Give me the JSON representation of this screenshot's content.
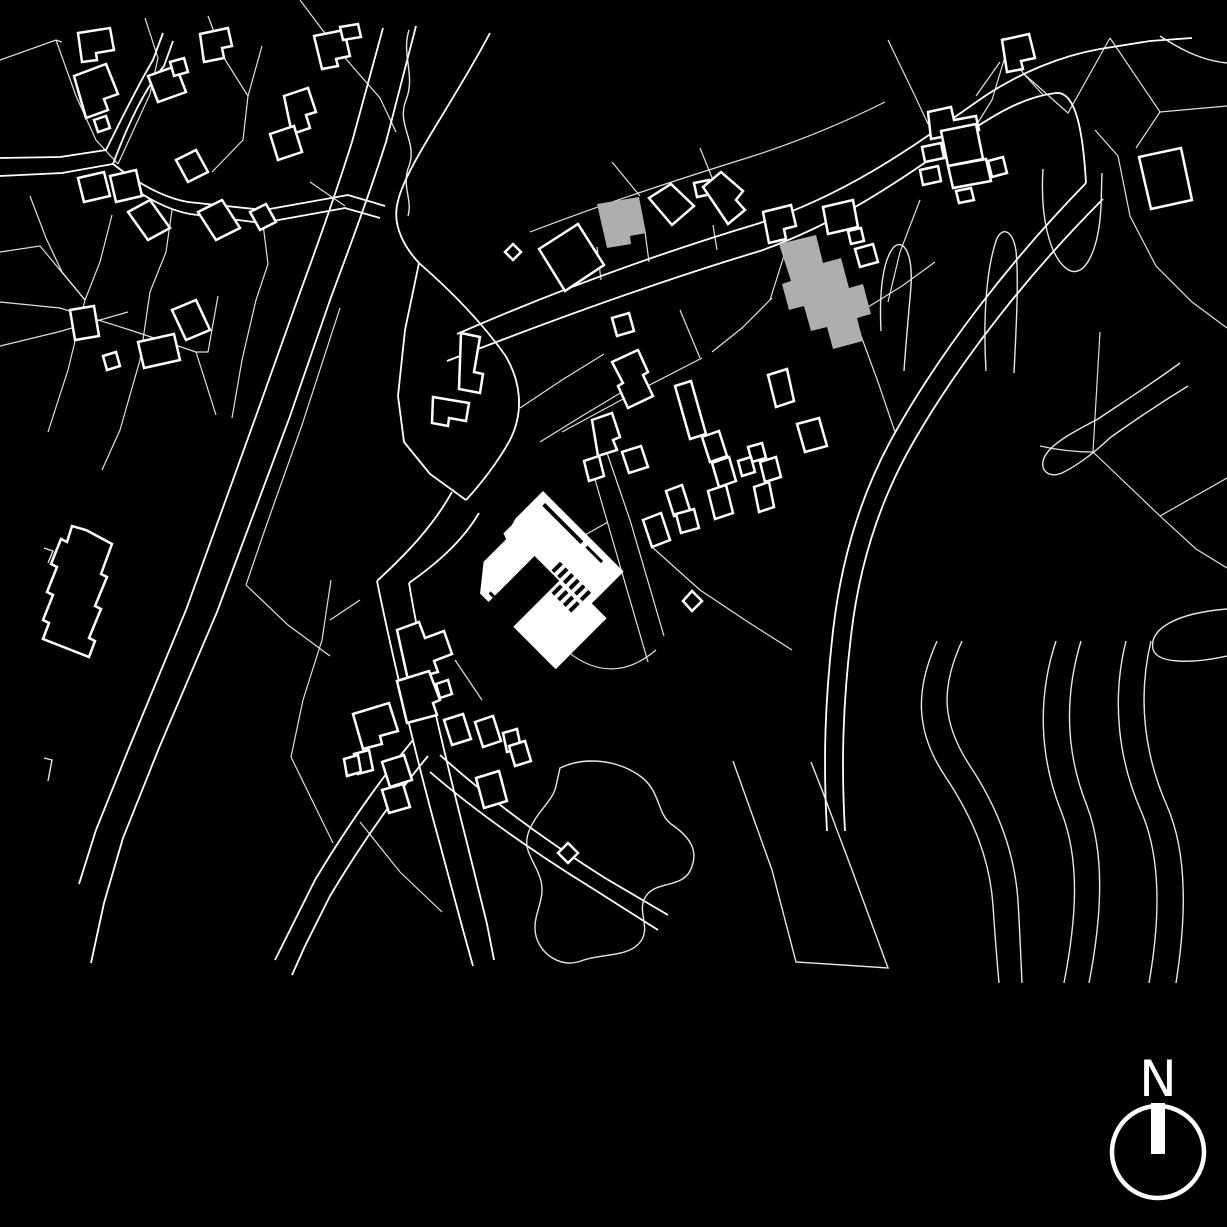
{
  "meta": {
    "type": "architectural site plan",
    "style": "black figure-ground drawing"
  },
  "colors": {
    "background": "#000000",
    "linework": "#f2f2f2",
    "highlight": "#ffffff",
    "context_fill": "#aeaeae"
  },
  "north_arrow": {
    "label": "N"
  },
  "map": {
    "parcel_lines": [
      "M 0,60 L 56,40 L 62,42",
      "M 56,40 L 76,96 L 96,140 L 118,164",
      "M 145,18 L 158,58 L 150,94",
      "M 208,16 L 224,58 L 248,96 L 243,140 L 212,172",
      "M 248,96 L 262,46",
      "M 300,0 L 330,40 L 352,66",
      "M 352,66 L 380,98 L 396,132",
      "M 150,94 L 118,164",
      "M 30,196 L 46,238 L 62,272 L 85,300",
      "M 112,215 L 100,262 L 85,300",
      "M 172,210 L 166,252 L 150,292",
      "M 263,224 L 268,264 L 256,300",
      "M 310,182 L 345,206",
      "M 0,252 L 40,246 L 85,300",
      "M 85,300 L 68,370 L 48,432",
      "M 150,292 L 140,360 L 120,430 L 102,470",
      "M 256,300 L 242,360 L 232,418",
      "M 0,346 L 58,332 L 128,312",
      "M 0,302 L 60,308 L 130,330 L 196,352",
      "M 218,296 L 208,352 L 196,352",
      "M 196,352 L 216,415",
      "M 340,308 L 302,425 L 263,535 L 246,585",
      "M 246,585 L 288,625 L 330,656",
      "M 530,232 C 600,205 670,182 750,157 C 800,141 845,122 885,102",
      "M 612,162 L 640,196",
      "M 700,148 L 713,180",
      "M 597,247 L 601,280",
      "M 645,232 L 649,262",
      "M 713,225 L 717,250",
      "M 770,300 L 788,243",
      "M 772,298 L 742,328 L 712,352",
      "M 860,333 L 878,382 L 895,432",
      "M 868,307 L 902,286 L 935,262",
      "M 680,310 L 700,358",
      "M 562,432 L 636,392 L 702,358",
      "M 652,547 L 700,590 L 748,622 L 792,650",
      "M 540,560 L 576,540 L 608,522",
      "M 590,462 L 614,545 L 648,662",
      "M 606,450 L 630,520 L 664,636",
      "M 520,408 L 562,380 L 604,354",
      "M 540,442 L 582,416 L 622,392",
      "M 331,580 L 322,640 L 303,700 L 291,757",
      "M 291,757 L 312,800 L 333,843",
      "M 360,822 L 400,872 L 442,912",
      "M 455,660 L 482,700",
      "M 330,620 L 360,600",
      "M 560,645 C 595,678 628,674 656,650",
      "M 888,40 L 915,96 L 928,124",
      "M 1010,40 L 992,100 L 977,124",
      "M 920,200 L 900,252 L 888,302",
      "M 1000,62 L 976,96",
      "M 1003,38 L 1023,73 L 1044,96",
      "M 1023,73 L 1068,113 L 1110,38",
      "M 1110,38 L 1160,112 L 1227,106",
      "M 1160,112 L 1136,148",
      "M 1118,156 L 1130,216 L 1156,266 L 1192,302 L 1227,328",
      "M 1095,130 L 1118,156",
      "M 1100,332 L 1093,452",
      "M 1040,446 C 1062,451 1080,452 1093,452",
      "M 1093,452 L 1160,516 L 1196,549 L 1227,568",
      "M 1160,516 L 1227,478"
    ],
    "roads": [
      "M 383,28 L 352,142 C 330,212 311,262 297,301 L 256,416 L 186,610 L 129,748 L 96,830 L 79,884",
      "M 416,26 L 386,142 C 363,214 343,264 329,303 L 289,419 L 217,612 L 159,748 L 123,838 L 104,903 L 91,963",
      "M 0,158 L 60,157 L 106,150 C 122,118 138,85 153,60 L 163,33",
      "M 0,176 L 62,173 L 113,164 C 128,124 144,90 164,66 L 173,41",
      "M 113,164 C 140,185 165,198 188,202 L 264,210 L 348,195 L 385,206",
      "M 117,177 C 145,198 168,210 190,214 L 262,223 L 345,208 L 380,218",
      "M 457,334 C 560,289 660,253 760,223 C 855,191 920,141 985,96 C 1020,73 1060,56 1100,49 L 1150,41 L 1192,38",
      "M 447,361 C 560,317 660,281 760,251 C 850,219 912,171 975,128 C 1005,108 1030,96 1056,93 C 1076,91 1083,132 1086,183",
      "M 490,33 C 452,105 406,166 398,201 C 391,226 406,249 419,263 C 450,290 480,320 505,355 C 520,380 525,410 510,440 C 498,462 480,485 466,500",
      "M 419,263 L 405,330 L 398,396 L 404,442 L 430,474 L 466,500",
      "M 452,492 C 432,528 404,556 377,581",
      "M 479,513 C 462,542 436,564 409,583",
      "M 377,581 C 391,650 416,758 441,848 L 463,930 L 473,966",
      "M 409,583 C 420,650 444,753 467,843 L 487,924 L 494,960",
      "M 413,740 C 380,780 345,830 315,880 L 290,930 L 275,960",
      "M 428,756 C 395,796 360,846 330,896 L 305,946 L 292,975",
      "M 440,755 C 490,800 545,840 605,878 L 668,915",
      "M 430,772 C 480,815 535,853 595,890 L 658,930",
      "M 1086,183 C 1010,261 941,351 896,431 C 861,492 841,561 833,631 C 825,701 823,761 827,831",
      "M 1103,199 C 1026,276 959,363 914,441 C 879,501 859,566 851,636 C 843,703 841,763 845,831"
    ],
    "organic_lines": [
      "M 409,30 C 401,55 416,75 406,100 C 396,125 418,142 409,166 C 401,186 413,200 408,216",
      "M 560,768 C 585,756 618,760 640,776 C 661,791 656,812 671,824 C 690,837 700,851 690,871 C 681,888 656,881 646,896 C 636,911 651,926 641,941 C 629,958 601,953 581,961 C 561,968 541,955 536,936 C 531,916 546,901 541,881 C 536,861 521,851 529,831 C 537,811 553,801 556,786 Z",
      "M 733,761 L 772,870 L 796,962 L 888,968 L 852,870 L 822,790 L 811,762",
      "M 937,641 C 915,690 915,731 945,776 C 975,821 990,861 993,906 C 995,936 997,961 999,983",
      "M 962,641 C 940,689 942,723 970,766 C 1000,811 1015,856 1018,901 C 1020,936 1021,961 1022,983",
      "M 1056,641 C 1036,701 1041,761 1061,811 C 1081,861 1076,921 1064,983",
      "M 1081,641 C 1063,701 1067,756 1087,806 C 1106,856 1101,921 1089,983",
      "M 1126,641 C 1111,701 1119,761 1141,811 C 1163,861 1159,926 1149,983",
      "M 1151,641 C 1137,699 1145,756 1167,806 C 1189,856 1185,926 1176,983",
      "M 1227,609 C 1176,613 1149,629 1153,649 C 1157,665 1196,663 1227,656",
      "M 1098,419 C 1075,431 1052,443 1045,456 C 1038,469 1048,479 1062,473 C 1082,463 1098,449 1111,437",
      "M 1098,419 C 1120,404 1150,385 1180,363",
      "M 1111,437 C 1135,420 1162,402 1188,386",
      "M 1043,169 C 1040,215 1049,256 1067,269 C 1085,281 1099,249 1101,206 L 1102,173",
      "M 881,331 C 879,291 883,261 893,248 C 903,237 913,253 911,286 C 909,311 906,341 904,371",
      "M 986,371 C 983,321 986,271 996,241 C 1001,226 1013,229 1016,251 C 1019,281 1016,331 1014,373",
      "M 1160,36 C 1186,53 1206,61 1227,63",
      "M 44,548 L 53,551 L 48,563",
      "M 44,758 L 52,760 L 48,781"
    ],
    "building_outlines": [
      "M 78,33 L 110,28 L 114,50 L 96,53 L 97,60 L 82,62 Z",
      "M 74,76 L 106,64 L 118,94 L 104,99 L 108,110 L 86,118 Z",
      "M 148,76 L 176,66 L 186,92 L 158,102 Z",
      "M 170,62 L 184,58 L 188,72 L 174,76 Z",
      "M 200,34 L 228,28 L 232,46 L 222,48 L 224,58 L 204,62 Z",
      "M 94,120 L 106,116 L 110,128 L 98,132 Z",
      "M 176,160 L 196,150 L 208,172 L 188,182 Z",
      "M 78,178 L 104,172 L 110,196 L 84,202 Z",
      "M 110,176 L 136,170 L 142,196 L 116,202 Z",
      "M 128,212 L 150,200 L 170,228 L 148,240 Z",
      "M 198,212 L 222,200 L 240,228 L 216,240 Z",
      "M 250,212 L 266,204 L 276,222 L 260,230 Z",
      "M 314,36 L 344,30 L 350,56 L 336,59 L 338,66 L 322,69 Z",
      "M 284,96 L 308,88 L 316,112 L 306,115 L 310,128 L 292,134 Z",
      "M 270,134 L 294,126 L 302,152 L 278,160 Z",
      "M 340,27 L 358,24 L 361,37 L 343,40 Z",
      "M 70,310 L 94,306 L 99,336 L 75,340 Z",
      "M 138,342 L 174,334 L 180,360 L 144,368 Z",
      "M 103,356 L 116,352 L 120,366 L 107,370 Z",
      "M 172,310 L 196,300 L 210,330 L 186,340 Z",
      "M 86,530 L 112,544 L 101,574 L 107,577 L 95,606 L 101,609 L 89,638 L 95,641 L 89,657 L 43,639 L 49,623 L 43,620 L 53,595 L 47,592 L 57,567 L 51,564 L 61,539 L 67,542 L 72,526 Z",
      "M 461,333 L 480,337 L 474,372 L 483,374 L 480,393 L 459,389 Z",
      "M 433,397 L 469,403 L 466,421 L 449,418 L 448,426 L 432,423 Z",
      "M 539,249 L 578,224 L 604,265 L 565,291 Z",
      "M 649,198 L 671,184 L 694,206 L 672,225 Z",
      "M 694,183 L 709,180 L 712,194 L 697,197 Z",
      "M 703,187 L 721,172 L 743,191 L 736,200 L 745,210 L 728,224 Z",
      "M 505,252 L 513,244 L 521,252 L 513,260 Z",
      "M 763,212 L 791,205 L 796,226 L 784,229 L 786,239 L 769,243 Z",
      "M 823,207 L 853,200 L 858,227 L 828,234 Z",
      "M 848,231 L 861,228 L 864,241 L 851,244 Z",
      "M 855,249 L 873,244 L 878,262 L 860,267 Z",
      "M 928,112 L 951,107 L 954,120 L 976,116 L 979,130 L 931,139 Z",
      "M 922,147 L 941,143 L 944,158 L 925,162 Z",
      "M 941,131 L 976,124 L 983,159 L 948,166 Z",
      "M 948,166 L 986,159 L 991,181 L 953,188 Z",
      "M 920,170 L 938,166 L 941,181 L 923,185 Z",
      "M 988,161 L 1003,157 L 1007,173 L 992,177 Z",
      "M 956,191 L 971,188 L 974,200 L 959,203 Z",
      "M 1002,40 L 1029,34 L 1035,58 L 1021,61 L 1023,69 L 1007,72 Z",
      "M 1139,157 L 1181,148 L 1192,200 L 1151,209 Z",
      "M 612,362 L 638,350 L 648,372 L 643,375 L 653,396 L 628,408 L 618,386 L 623,383 Z",
      "M 675,386 L 691,381 L 706,434 L 690,439 Z",
      "M 768,375 L 787,369 L 794,401 L 776,407 Z",
      "M 748,447 L 762,443 L 766,458 L 752,462 Z",
      "M 797,424 L 819,418 L 827,446 L 805,452 Z",
      "M 760,462 L 776,457 L 781,477 L 765,482 Z",
      "M 738,461 L 751,457 L 755,472 L 742,476 Z",
      "M 702,437 L 719,431 L 727,456 L 710,462 Z",
      "M 712,463 L 729,457 L 736,481 L 719,487 Z",
      "M 754,487 L 769,482 L 774,507 L 759,512 Z",
      "M 708,491 L 726,485 L 733,513 L 715,519 Z",
      "M 592,420 L 612,413 L 620,437 L 613,440 L 617,450 L 598,456 Z",
      "M 622,452 L 641,446 L 648,467 L 629,473 Z",
      "M 584,461 L 599,456 L 604,476 L 589,481 Z",
      "M 666,491 L 682,485 L 690,510 L 674,516 Z",
      "M 676,514 L 694,509 L 699,528 L 681,533 Z",
      "M 643,520 L 661,513 L 670,540 L 652,547 Z",
      "M 612,318 L 629,313 L 634,331 L 617,336 Z",
      "M 683,601 L 692,591 L 702,601 L 692,611 Z",
      "M 397,630 L 419,622 L 425,638 L 444,631 L 452,654 L 434,661 L 438,672 L 408,680 Z",
      "M 397,681 L 429,671 L 440,700 L 433,703 L 437,715 L 407,723 Z",
      "M 436,684 L 448,680 L 452,694 L 440,698 Z",
      "M 353,714 L 389,703 L 398,731 L 380,736 L 382,744 L 363,749 Z",
      "M 354,754 L 369,750 L 373,770 L 358,774 Z",
      "M 382,762 L 404,755 L 412,780 L 390,787 Z",
      "M 344,759 L 358,755 L 361,772 L 347,776 Z",
      "M 382,790 L 403,784 L 410,807 L 389,813 Z",
      "M 444,720 L 463,714 L 471,739 L 452,745 Z",
      "M 475,722 L 493,716 L 501,741 L 483,747 Z",
      "M 503,733 L 517,729 L 521,748 L 507,752 Z",
      "M 509,746 L 525,741 L 531,761 L 515,766 Z",
      "M 476,778 L 499,771 L 507,801 L 484,808 Z",
      "M 558,853 L 568,843 L 578,853 L 568,863 Z"
    ],
    "gray_buildings": [
      "M 597,204 L 639,197 L 646,233 L 630,236 L 631,244 L 607,248 Z",
      "M 779,244 L 816,235 L 823,263 L 841,258 L 849,288 L 863,284 L 871,314 L 857,318 L 863,341 L 833,349 L 827,327 L 811,331 L 804,306 L 789,310 L 782,284 L 791,281 Z"
    ],
    "main_building": {
      "transform": "translate(543,491) rotate(45)",
      "outline": "M 0,0 L 114,0 L 114,45 L 135,45 L 135,117 L 75,117 L 75,52 L 40,52 L 40,117 L 28,117 L 8,92 L 8,60 L 2,58 L 2,46 L 0,39 Z",
      "details": [
        "M 10,7 h54 v4 h-54 Z",
        "M 70,7 h22 v3 h-22 Z",
        "M 34,108 h6 v3 h-6 Z",
        "M 62,38 h4 v12 h-4 Z",
        "M 70,38 h4 v12 h-4 Z",
        "M 78,38 h4 v12 h-4 Z",
        "M 86,38 h4 v12 h-4 Z",
        "M 94,38 h4 v12 h-4 Z",
        "M 102,38 h4 v12 h-4 Z",
        "M 70,54 h4 v12 h-4 Z",
        "M 78,54 h4 v12 h-4 Z",
        "M 86,54 h4 v12 h-4 Z",
        "M 94,54 h4 v12 h-4 Z",
        "M 102,54 h4 v12 h-4 Z"
      ]
    }
  }
}
